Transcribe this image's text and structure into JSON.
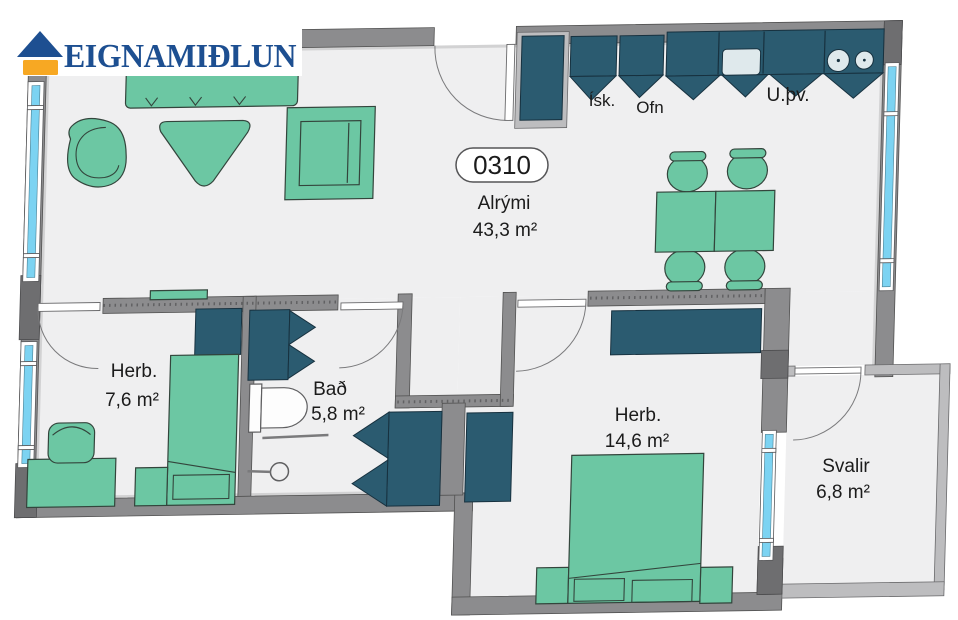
{
  "brand": {
    "name": "EIGNAMIÐLUN"
  },
  "unit": {
    "number": "0310"
  },
  "rooms": {
    "alrymi": {
      "name": "Alrými",
      "area": "43,3 m²"
    },
    "herb_small": {
      "name": "Herb.",
      "area": "7,6 m²"
    },
    "bad": {
      "name": "Bað",
      "area": "5,8 m²"
    },
    "herb_large": {
      "name": "Herb.",
      "area": "14,6 m²"
    },
    "svalir": {
      "name": "Svalir",
      "area": "6,8 m²"
    }
  },
  "appliances": {
    "fridge": "Ísk.",
    "oven": "Ofn",
    "utility": "U.þv."
  },
  "colors": {
    "furniture_green": "#6cc7a3",
    "cabinet_teal": "#2b5b70",
    "wall_gray": "#8c8c8e",
    "wall_light": "#bdbdbf",
    "floor": "#efeff0",
    "window_cyan": "#7cd3f2",
    "logo_blue": "#1d4f91",
    "logo_orange": "#f7a823"
  }
}
